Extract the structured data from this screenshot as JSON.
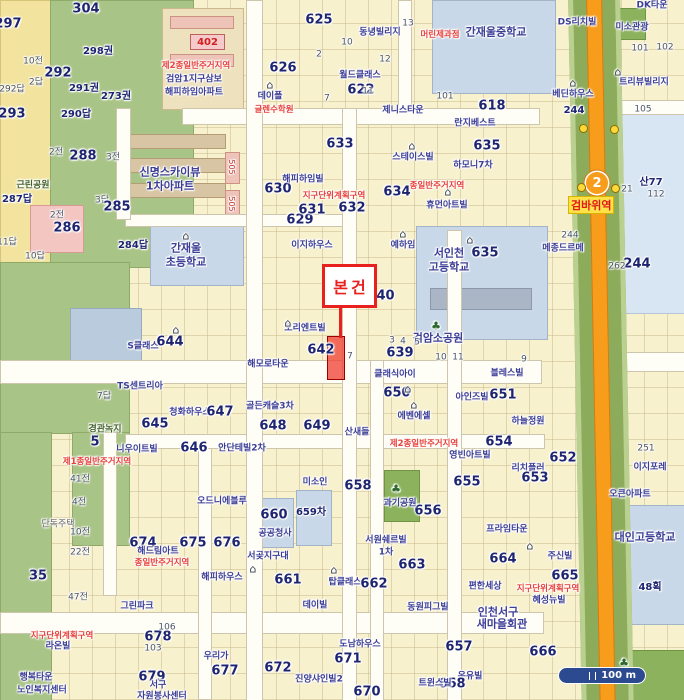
{
  "palette": {
    "parcel": "#f8f1cd",
    "park": "#a9c487",
    "school": "#c9d8e8",
    "rail_green": "#8cab5b",
    "line_orange": "#f89c1c",
    "road": "#fffef6",
    "marker_red": "#e8201e",
    "zone_red": "#e8403a",
    "lot_navy": "#1d2470",
    "building_blue": "#3c3e96",
    "station_bg": "#ffe24a",
    "scale_bg": "#2c4a8f"
  },
  "marker": {
    "label": "본건"
  },
  "station": {
    "line_number": "2",
    "name": "검바위역"
  },
  "scale_bar": {
    "label": "100 m"
  },
  "apartment_badge": {
    "text": "402"
  },
  "labels": [
    {
      "t": "304",
      "x": 86,
      "y": 9,
      "k": "lot-lg"
    },
    {
      "t": "297",
      "x": 8,
      "y": 24,
      "k": "lot-lg"
    },
    {
      "t": "298권",
      "x": 98,
      "y": 52,
      "k": "lot"
    },
    {
      "t": "292",
      "x": 58,
      "y": 73,
      "k": "lot-lg"
    },
    {
      "t": "291권",
      "x": 84,
      "y": 89,
      "k": "lot"
    },
    {
      "t": "273권",
      "x": 116,
      "y": 97,
      "k": "lot"
    },
    {
      "t": "290답",
      "x": 76,
      "y": 115,
      "k": "lot"
    },
    {
      "t": "293",
      "x": 12,
      "y": 114,
      "k": "lot-lg"
    },
    {
      "t": "10전",
      "x": 33,
      "y": 62,
      "k": "lot-sm"
    },
    {
      "t": "2답",
      "x": 36,
      "y": 83,
      "k": "lot-sm"
    },
    {
      "t": "292답",
      "x": 12,
      "y": 90,
      "k": "lot-sm"
    },
    {
      "t": "288",
      "x": 83,
      "y": 156,
      "k": "lot-lg"
    },
    {
      "t": "2전",
      "x": 56,
      "y": 153,
      "k": "lot-sm"
    },
    {
      "t": "3전",
      "x": 113,
      "y": 158,
      "k": "lot-sm"
    },
    {
      "t": "근린공원",
      "x": 33,
      "y": 186,
      "k": "green"
    },
    {
      "t": "287답",
      "x": 17,
      "y": 200,
      "k": "lot"
    },
    {
      "t": "3답",
      "x": 102,
      "y": 201,
      "k": "lot-sm"
    },
    {
      "t": "285",
      "x": 117,
      "y": 207,
      "k": "lot-lg"
    },
    {
      "t": "286",
      "x": 67,
      "y": 228,
      "k": "lot-lg"
    },
    {
      "t": "2전",
      "x": 57,
      "y": 216,
      "k": "lot-sm"
    },
    {
      "t": "284답",
      "x": 133,
      "y": 246,
      "k": "lot"
    },
    {
      "t": "10답",
      "x": 35,
      "y": 257,
      "k": "lot-sm"
    },
    {
      "t": "11답",
      "x": 7,
      "y": 243,
      "k": "lot-sm"
    },
    {
      "t": "제2종일반주거지역",
      "x": 196,
      "y": 66,
      "k": "red"
    },
    {
      "t": "검암1지구삼보",
      "x": 194,
      "y": 80,
      "k": "bldg"
    },
    {
      "t": "해피하임아파트",
      "x": 194,
      "y": 93,
      "k": "bldg"
    },
    {
      "t": "625",
      "x": 319,
      "y": 20,
      "k": "lot-lg"
    },
    {
      "t": "626",
      "x": 283,
      "y": 68,
      "k": "lot-lg"
    },
    {
      "t": "데이플",
      "x": 270,
      "y": 97,
      "k": "bldg"
    },
    {
      "t": "글렌수학원",
      "x": 274,
      "y": 110,
      "k": "red"
    },
    {
      "t": "동녕빌리지",
      "x": 380,
      "y": 33,
      "k": "bldg"
    },
    {
      "t": "월드클래스",
      "x": 360,
      "y": 76,
      "k": "bldg"
    },
    {
      "t": "622",
      "x": 361,
      "y": 90,
      "k": "lot-lg"
    },
    {
      "t": "제니스타운",
      "x": 403,
      "y": 111,
      "k": "bldg"
    },
    {
      "t": "머린제과점",
      "x": 440,
      "y": 35,
      "k": "red"
    },
    {
      "t": "2",
      "x": 319,
      "y": 55,
      "k": "lot-sm"
    },
    {
      "t": "10",
      "x": 347,
      "y": 43,
      "k": "lot-sm"
    },
    {
      "t": "13",
      "x": 408,
      "y": 24,
      "k": "lot-sm"
    },
    {
      "t": "12",
      "x": 385,
      "y": 60,
      "k": "lot-sm"
    },
    {
      "t": "11",
      "x": 368,
      "y": 92,
      "k": "lot-sm"
    },
    {
      "t": "7",
      "x": 327,
      "y": 99,
      "k": "lot-sm"
    },
    {
      "t": "101",
      "x": 445,
      "y": 97,
      "k": "lot-sm"
    },
    {
      "t": "간재울중학교",
      "x": 496,
      "y": 32,
      "k": "bldg-lg"
    },
    {
      "t": "DS리치빌",
      "x": 577,
      "y": 23,
      "k": "bldg"
    },
    {
      "t": "미소관광",
      "x": 632,
      "y": 28,
      "k": "bldg"
    },
    {
      "t": "DK타운",
      "x": 652,
      "y": 6,
      "k": "bldg"
    },
    {
      "t": "트리뷰빌리지",
      "x": 644,
      "y": 83,
      "k": "bldg"
    },
    {
      "t": "베딘하우스",
      "x": 573,
      "y": 95,
      "k": "bldg"
    },
    {
      "t": "618",
      "x": 492,
      "y": 106,
      "k": "lot-lg"
    },
    {
      "t": "101",
      "x": 640,
      "y": 49,
      "k": "lot-sm"
    },
    {
      "t": "102",
      "x": 665,
      "y": 48,
      "k": "lot-sm"
    },
    {
      "t": "105",
      "x": 643,
      "y": 110,
      "k": "lot-sm"
    },
    {
      "t": "244",
      "x": 574,
      "y": 111,
      "k": "lot"
    },
    {
      "t": "산77",
      "x": 651,
      "y": 183,
      "k": "lot"
    },
    {
      "t": "112",
      "x": 656,
      "y": 195,
      "k": "lot-sm"
    },
    {
      "t": "21",
      "x": 627,
      "y": 190,
      "k": "lot-sm"
    },
    {
      "t": "244",
      "x": 637,
      "y": 264,
      "k": "lot-lg"
    },
    {
      "t": "262",
      "x": 617,
      "y": 267,
      "k": "lot-sm"
    },
    {
      "t": "신명스카이뷰",
      "x": 170,
      "y": 172,
      "k": "bldg-lg"
    },
    {
      "t": "1차아파트",
      "x": 170,
      "y": 186,
      "k": "bldg-lg"
    },
    {
      "t": "629",
      "x": 300,
      "y": 220,
      "k": "lot-lg"
    },
    {
      "t": "630",
      "x": 278,
      "y": 189,
      "k": "lot-lg"
    },
    {
      "t": "631",
      "x": 312,
      "y": 210,
      "k": "lot-lg"
    },
    {
      "t": "해피하임빌",
      "x": 303,
      "y": 180,
      "k": "bldg"
    },
    {
      "t": "지구단위계획구역",
      "x": 334,
      "y": 196,
      "k": "red"
    },
    {
      "t": "간재울",
      "x": 186,
      "y": 248,
      "k": "bldg-lg"
    },
    {
      "t": "초등학교",
      "x": 186,
      "y": 262,
      "k": "bldg-lg"
    },
    {
      "t": "이지하우스",
      "x": 312,
      "y": 246,
      "k": "bldg"
    },
    {
      "t": "505",
      "x": 231,
      "y": 167,
      "k": "v"
    },
    {
      "t": "505",
      "x": 231,
      "y": 204,
      "k": "v"
    },
    {
      "t": "예하임",
      "x": 403,
      "y": 246,
      "k": "bldg"
    },
    {
      "t": "서인천",
      "x": 449,
      "y": 253,
      "k": "bldg-lg"
    },
    {
      "t": "635",
      "x": 485,
      "y": 253,
      "k": "lot-lg"
    },
    {
      "t": "고등학교",
      "x": 449,
      "y": 267,
      "k": "bldg-lg"
    },
    {
      "t": "640",
      "x": 381,
      "y": 296,
      "k": "lot-lg"
    },
    {
      "t": "오리엔트빌",
      "x": 305,
      "y": 329,
      "k": "bldg"
    },
    {
      "t": "642",
      "x": 321,
      "y": 350,
      "k": "lot-lg"
    },
    {
      "t": "검암소공원",
      "x": 438,
      "y": 338,
      "k": "bldg-lg"
    },
    {
      "t": "639",
      "x": 400,
      "y": 353,
      "k": "lot-lg"
    },
    {
      "t": "클래식아이",
      "x": 395,
      "y": 375,
      "k": "bldg"
    },
    {
      "t": "하모니7차",
      "x": 473,
      "y": 166,
      "k": "bldg"
    },
    {
      "t": "종일반주거지역",
      "x": 437,
      "y": 186,
      "k": "red"
    },
    {
      "t": "휴먼아트빌",
      "x": 447,
      "y": 206,
      "k": "bldg"
    },
    {
      "t": "634",
      "x": 397,
      "y": 192,
      "k": "lot-lg"
    },
    {
      "t": "632",
      "x": 352,
      "y": 208,
      "k": "lot-lg"
    },
    {
      "t": "633",
      "x": 340,
      "y": 144,
      "k": "lot-lg"
    },
    {
      "t": "스테이스빌",
      "x": 413,
      "y": 158,
      "k": "bldg"
    },
    {
      "t": "란지베스트",
      "x": 475,
      "y": 124,
      "k": "bldg"
    },
    {
      "t": "635",
      "x": 487,
      "y": 146,
      "k": "lot-lg"
    },
    {
      "t": "메종드르메",
      "x": 563,
      "y": 249,
      "k": "bldg"
    },
    {
      "t": "244",
      "x": 570,
      "y": 236,
      "k": "lot-sm"
    },
    {
      "t": "3",
      "x": 392,
      "y": 341,
      "k": "lot-sm"
    },
    {
      "t": "4",
      "x": 403,
      "y": 342,
      "k": "lot-sm"
    },
    {
      "t": "5",
      "x": 417,
      "y": 343,
      "k": "lot-sm"
    },
    {
      "t": "7",
      "x": 350,
      "y": 357,
      "k": "lot-sm"
    },
    {
      "t": "10",
      "x": 441,
      "y": 358,
      "k": "lot-sm"
    },
    {
      "t": "11",
      "x": 458,
      "y": 358,
      "k": "lot-sm"
    },
    {
      "t": "9",
      "x": 524,
      "y": 360,
      "k": "lot-sm"
    },
    {
      "t": "해모로타운",
      "x": 268,
      "y": 365,
      "k": "bldg"
    },
    {
      "t": "골든캐슬3차",
      "x": 270,
      "y": 407,
      "k": "bldg"
    },
    {
      "t": "청화하우스",
      "x": 190,
      "y": 413,
      "k": "bldg"
    },
    {
      "t": "647",
      "x": 220,
      "y": 412,
      "k": "lot-lg"
    },
    {
      "t": "648",
      "x": 273,
      "y": 426,
      "k": "lot-lg"
    },
    {
      "t": "649",
      "x": 317,
      "y": 426,
      "k": "lot-lg"
    },
    {
      "t": "645",
      "x": 155,
      "y": 424,
      "k": "lot-lg"
    },
    {
      "t": "646",
      "x": 194,
      "y": 448,
      "k": "lot-lg"
    },
    {
      "t": "안단테빌2차",
      "x": 242,
      "y": 449,
      "k": "bldg"
    },
    {
      "t": "TS센트리아",
      "x": 140,
      "y": 387,
      "k": "bldg"
    },
    {
      "t": "S클래스",
      "x": 143,
      "y": 347,
      "k": "bldg"
    },
    {
      "t": "644",
      "x": 170,
      "y": 342,
      "k": "lot-lg"
    },
    {
      "t": "7답",
      "x": 104,
      "y": 397,
      "k": "lot-sm"
    },
    {
      "t": "경관녹지",
      "x": 105,
      "y": 430,
      "k": "green"
    },
    {
      "t": "블레스빌",
      "x": 507,
      "y": 374,
      "k": "bldg"
    },
    {
      "t": "650",
      "x": 397,
      "y": 393,
      "k": "lot-lg"
    },
    {
      "t": "아인즈빌",
      "x": 472,
      "y": 398,
      "k": "bldg"
    },
    {
      "t": "651",
      "x": 503,
      "y": 395,
      "k": "lot-lg"
    },
    {
      "t": "하늘정원",
      "x": 528,
      "y": 422,
      "k": "bldg"
    },
    {
      "t": "에벤에셀",
      "x": 414,
      "y": 417,
      "k": "bldg"
    },
    {
      "t": "제2종일반주거지역",
      "x": 424,
      "y": 444,
      "k": "red"
    },
    {
      "t": "산새들",
      "x": 357,
      "y": 433,
      "k": "bldg"
    },
    {
      "t": "658",
      "x": 358,
      "y": 486,
      "k": "lot-lg"
    },
    {
      "t": "655",
      "x": 467,
      "y": 482,
      "k": "lot-lg"
    },
    {
      "t": "656",
      "x": 428,
      "y": 511,
      "k": "lot-lg"
    },
    {
      "t": "654",
      "x": 499,
      "y": 442,
      "k": "lot-lg"
    },
    {
      "t": "영빈아트빌",
      "x": 470,
      "y": 456,
      "k": "bldg"
    },
    {
      "t": "652",
      "x": 563,
      "y": 458,
      "k": "lot-lg"
    },
    {
      "t": "리치플러",
      "x": 528,
      "y": 469,
      "k": "bldg"
    },
    {
      "t": "653",
      "x": 535,
      "y": 478,
      "k": "lot-lg"
    },
    {
      "t": "프라임타운",
      "x": 507,
      "y": 530,
      "k": "bldg"
    },
    {
      "t": "주신빌",
      "x": 560,
      "y": 557,
      "k": "bldg"
    },
    {
      "t": "664",
      "x": 503,
      "y": 559,
      "k": "lot-lg"
    },
    {
      "t": "663",
      "x": 412,
      "y": 565,
      "k": "lot-lg"
    },
    {
      "t": "665",
      "x": 565,
      "y": 576,
      "k": "lot-lg"
    },
    {
      "t": "과기공원",
      "x": 400,
      "y": 504,
      "k": "bldg"
    },
    {
      "t": "서원쉐르빌",
      "x": 386,
      "y": 541,
      "k": "bldg"
    },
    {
      "t": "1차",
      "x": 386,
      "y": 553,
      "k": "bldg"
    },
    {
      "t": "657",
      "x": 459,
      "y": 647,
      "k": "lot-lg"
    },
    {
      "t": "666",
      "x": 543,
      "y": 652,
      "k": "lot-lg"
    },
    {
      "t": "온유빌",
      "x": 470,
      "y": 677,
      "k": "bldg"
    },
    {
      "t": "668",
      "x": 452,
      "y": 684,
      "k": "lot-lg"
    },
    {
      "t": "편한세상",
      "x": 485,
      "y": 587,
      "k": "bldg"
    },
    {
      "t": "지구단위계획구역",
      "x": 548,
      "y": 589,
      "k": "red"
    },
    {
      "t": "혜성뉴빌",
      "x": 549,
      "y": 601,
      "k": "bldg"
    },
    {
      "t": "인천서구",
      "x": 498,
      "y": 612,
      "k": "bldg-lg"
    },
    {
      "t": "새마을회관",
      "x": 502,
      "y": 624,
      "k": "bldg-lg"
    },
    {
      "t": "이지포레",
      "x": 650,
      "y": 468,
      "k": "bldg"
    },
    {
      "t": "오큰아파트",
      "x": 630,
      "y": 495,
      "k": "bldg"
    },
    {
      "t": "대인고등학교",
      "x": 645,
      "y": 537,
      "k": "bldg-lg"
    },
    {
      "t": "48획",
      "x": 650,
      "y": 588,
      "k": "lot"
    },
    {
      "t": "251",
      "x": 646,
      "y": 449,
      "k": "lot-sm"
    },
    {
      "t": "59",
      "x": 620,
      "y": 677,
      "k": "lot"
    },
    {
      "t": "니우이트빌",
      "x": 137,
      "y": 450,
      "k": "bldg"
    },
    {
      "t": "5",
      "x": 95,
      "y": 442,
      "k": "lot-lg"
    },
    {
      "t": "제1종일반주거지역",
      "x": 97,
      "y": 462,
      "k": "red"
    },
    {
      "t": "41전",
      "x": 80,
      "y": 480,
      "k": "lot-sm"
    },
    {
      "t": "4전",
      "x": 79,
      "y": 503,
      "k": "lot-sm"
    },
    {
      "t": "단독주택",
      "x": 58,
      "y": 525,
      "k": "gray"
    },
    {
      "t": "10전",
      "x": 80,
      "y": 533,
      "k": "lot-sm"
    },
    {
      "t": "22전",
      "x": 80,
      "y": 553,
      "k": "lot-sm"
    },
    {
      "t": "674",
      "x": 143,
      "y": 543,
      "k": "lot-lg"
    },
    {
      "t": "675",
      "x": 193,
      "y": 543,
      "k": "lot-lg"
    },
    {
      "t": "해드림아트",
      "x": 158,
      "y": 552,
      "k": "bldg"
    },
    {
      "t": "종일반주거지역",
      "x": 162,
      "y": 563,
      "k": "red"
    },
    {
      "t": "오드니에블루",
      "x": 222,
      "y": 502,
      "k": "bldg"
    },
    {
      "t": "676",
      "x": 227,
      "y": 543,
      "k": "lot-lg"
    },
    {
      "t": "해피하우스",
      "x": 222,
      "y": 578,
      "k": "bldg"
    },
    {
      "t": "35",
      "x": 38,
      "y": 576,
      "k": "lot-lg"
    },
    {
      "t": "47전",
      "x": 78,
      "y": 598,
      "k": "lot-sm"
    },
    {
      "t": "그린파크",
      "x": 137,
      "y": 607,
      "k": "bldg"
    },
    {
      "t": "지구단위계획구역",
      "x": 62,
      "y": 636,
      "k": "red"
    },
    {
      "t": "라온빌",
      "x": 58,
      "y": 647,
      "k": "bldg"
    },
    {
      "t": "행복타운",
      "x": 36,
      "y": 678,
      "k": "bldg"
    },
    {
      "t": "노인복지센터",
      "x": 42,
      "y": 691,
      "k": "bldg"
    },
    {
      "t": "678",
      "x": 158,
      "y": 637,
      "k": "lot-lg"
    },
    {
      "t": "679",
      "x": 152,
      "y": 677,
      "k": "lot-lg"
    },
    {
      "t": "서구",
      "x": 158,
      "y": 686,
      "k": "bldg"
    },
    {
      "t": "자원봉사센터",
      "x": 162,
      "y": 697,
      "k": "bldg"
    },
    {
      "t": "우리가",
      "x": 216,
      "y": 657,
      "k": "bldg"
    },
    {
      "t": "677",
      "x": 225,
      "y": 671,
      "k": "lot-lg"
    },
    {
      "t": "103",
      "x": 153,
      "y": 649,
      "k": "lot-sm"
    },
    {
      "t": "106",
      "x": 167,
      "y": 628,
      "k": "lot-sm"
    },
    {
      "t": "미소인",
      "x": 315,
      "y": 483,
      "k": "bldg"
    },
    {
      "t": "660",
      "x": 274,
      "y": 515,
      "k": "lot-lg"
    },
    {
      "t": "공공청사",
      "x": 275,
      "y": 534,
      "k": "bldg"
    },
    {
      "t": "659차",
      "x": 311,
      "y": 513,
      "k": "lot"
    },
    {
      "t": "서곶지구대",
      "x": 268,
      "y": 557,
      "k": "bldg"
    },
    {
      "t": "661",
      "x": 288,
      "y": 580,
      "k": "lot-lg"
    },
    {
      "t": "탑클래스",
      "x": 345,
      "y": 583,
      "k": "bldg"
    },
    {
      "t": "662",
      "x": 374,
      "y": 584,
      "k": "lot-lg"
    },
    {
      "t": "데이빌",
      "x": 315,
      "y": 606,
      "k": "bldg"
    },
    {
      "t": "동원피그빌",
      "x": 428,
      "y": 608,
      "k": "bldg"
    },
    {
      "t": "도남하우스",
      "x": 360,
      "y": 645,
      "k": "bldg"
    },
    {
      "t": "671",
      "x": 348,
      "y": 659,
      "k": "lot-lg"
    },
    {
      "t": "672",
      "x": 278,
      "y": 668,
      "k": "lot-lg"
    },
    {
      "t": "진양샤인빌2",
      "x": 319,
      "y": 680,
      "k": "bldg"
    },
    {
      "t": "670",
      "x": 367,
      "y": 692,
      "k": "lot-lg"
    },
    {
      "t": "트윈스빌",
      "x": 435,
      "y": 684,
      "k": "bldg"
    },
    {
      "t": "⌂",
      "x": 288,
      "y": 323,
      "k": "ih"
    },
    {
      "t": "⌂",
      "x": 403,
      "y": 234,
      "k": "ih"
    },
    {
      "t": "⌂",
      "x": 448,
      "y": 192,
      "k": "ih"
    },
    {
      "t": "⌂",
      "x": 334,
      "y": 570,
      "k": "ih"
    },
    {
      "t": "⌂",
      "x": 253,
      "y": 569,
      "k": "ih"
    },
    {
      "t": "⌂",
      "x": 530,
      "y": 546,
      "k": "ih"
    },
    {
      "t": "⌂",
      "x": 618,
      "y": 72,
      "k": "ih"
    },
    {
      "t": "⌂",
      "x": 573,
      "y": 83,
      "k": "ih"
    },
    {
      "t": "⌂",
      "x": 176,
      "y": 330,
      "k": "ih"
    },
    {
      "t": "⌂",
      "x": 186,
      "y": 236,
      "k": "ih"
    },
    {
      "t": "⌂",
      "x": 470,
      "y": 240,
      "k": "ih"
    },
    {
      "t": "⌂",
      "x": 412,
      "y": 146,
      "k": "ih"
    },
    {
      "t": "⌂",
      "x": 270,
      "y": 85,
      "k": "ih"
    },
    {
      "t": "⌂",
      "x": 408,
      "y": 389,
      "k": "ih"
    },
    {
      "t": "⌂",
      "x": 414,
      "y": 405,
      "k": "ih"
    },
    {
      "t": "♣",
      "x": 436,
      "y": 326,
      "k": "it"
    },
    {
      "t": "♣",
      "x": 396,
      "y": 489,
      "k": "it"
    },
    {
      "t": "♣",
      "x": 624,
      "y": 663,
      "k": "it"
    }
  ]
}
